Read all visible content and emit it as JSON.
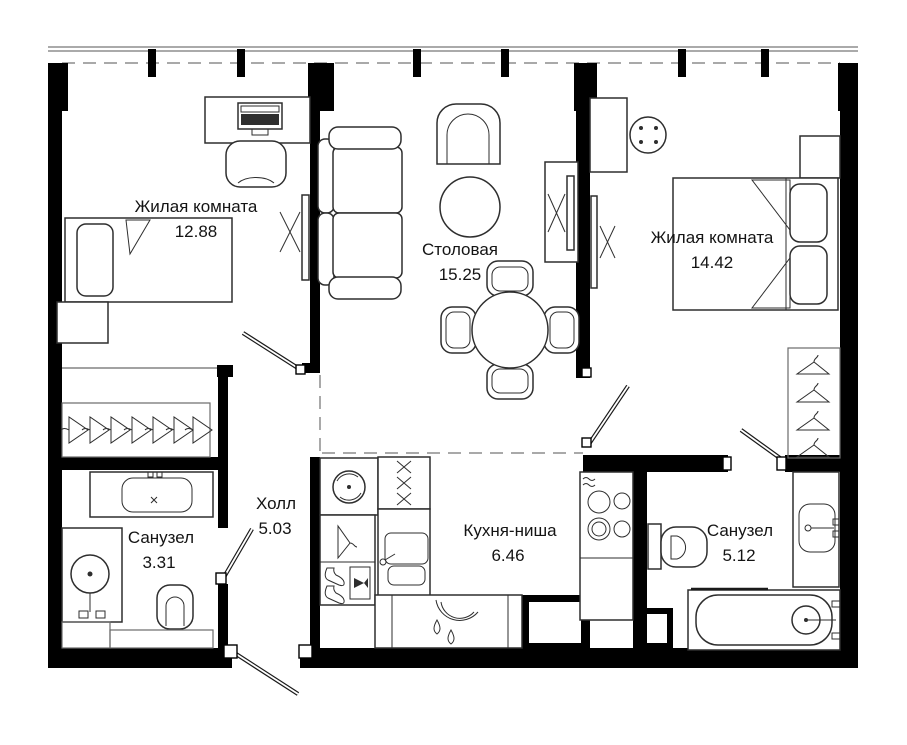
{
  "title": "Apartment floor plan",
  "rooms": [
    {
      "id": "living-1",
      "name": "Жилая комната",
      "area": "12.88"
    },
    {
      "id": "dining",
      "name": "Столовая",
      "area": "15.25"
    },
    {
      "id": "living-2",
      "name": "Жилая комната",
      "area": "14.42"
    },
    {
      "id": "hall",
      "name": "Холл",
      "area": "5.03"
    },
    {
      "id": "bath-1",
      "name": "Санузел",
      "area": "3.31"
    },
    {
      "id": "kitchen",
      "name": "Кухня-ниша",
      "area": "6.46"
    },
    {
      "id": "bath-2",
      "name": "Санузел",
      "area": "5.12"
    }
  ],
  "colors": {
    "walls": "#000000",
    "furniture_stroke": "#2e2e2e",
    "dashed_boundary": "#a9a9a9",
    "label_text": "#141414",
    "background": "#ffffff"
  }
}
